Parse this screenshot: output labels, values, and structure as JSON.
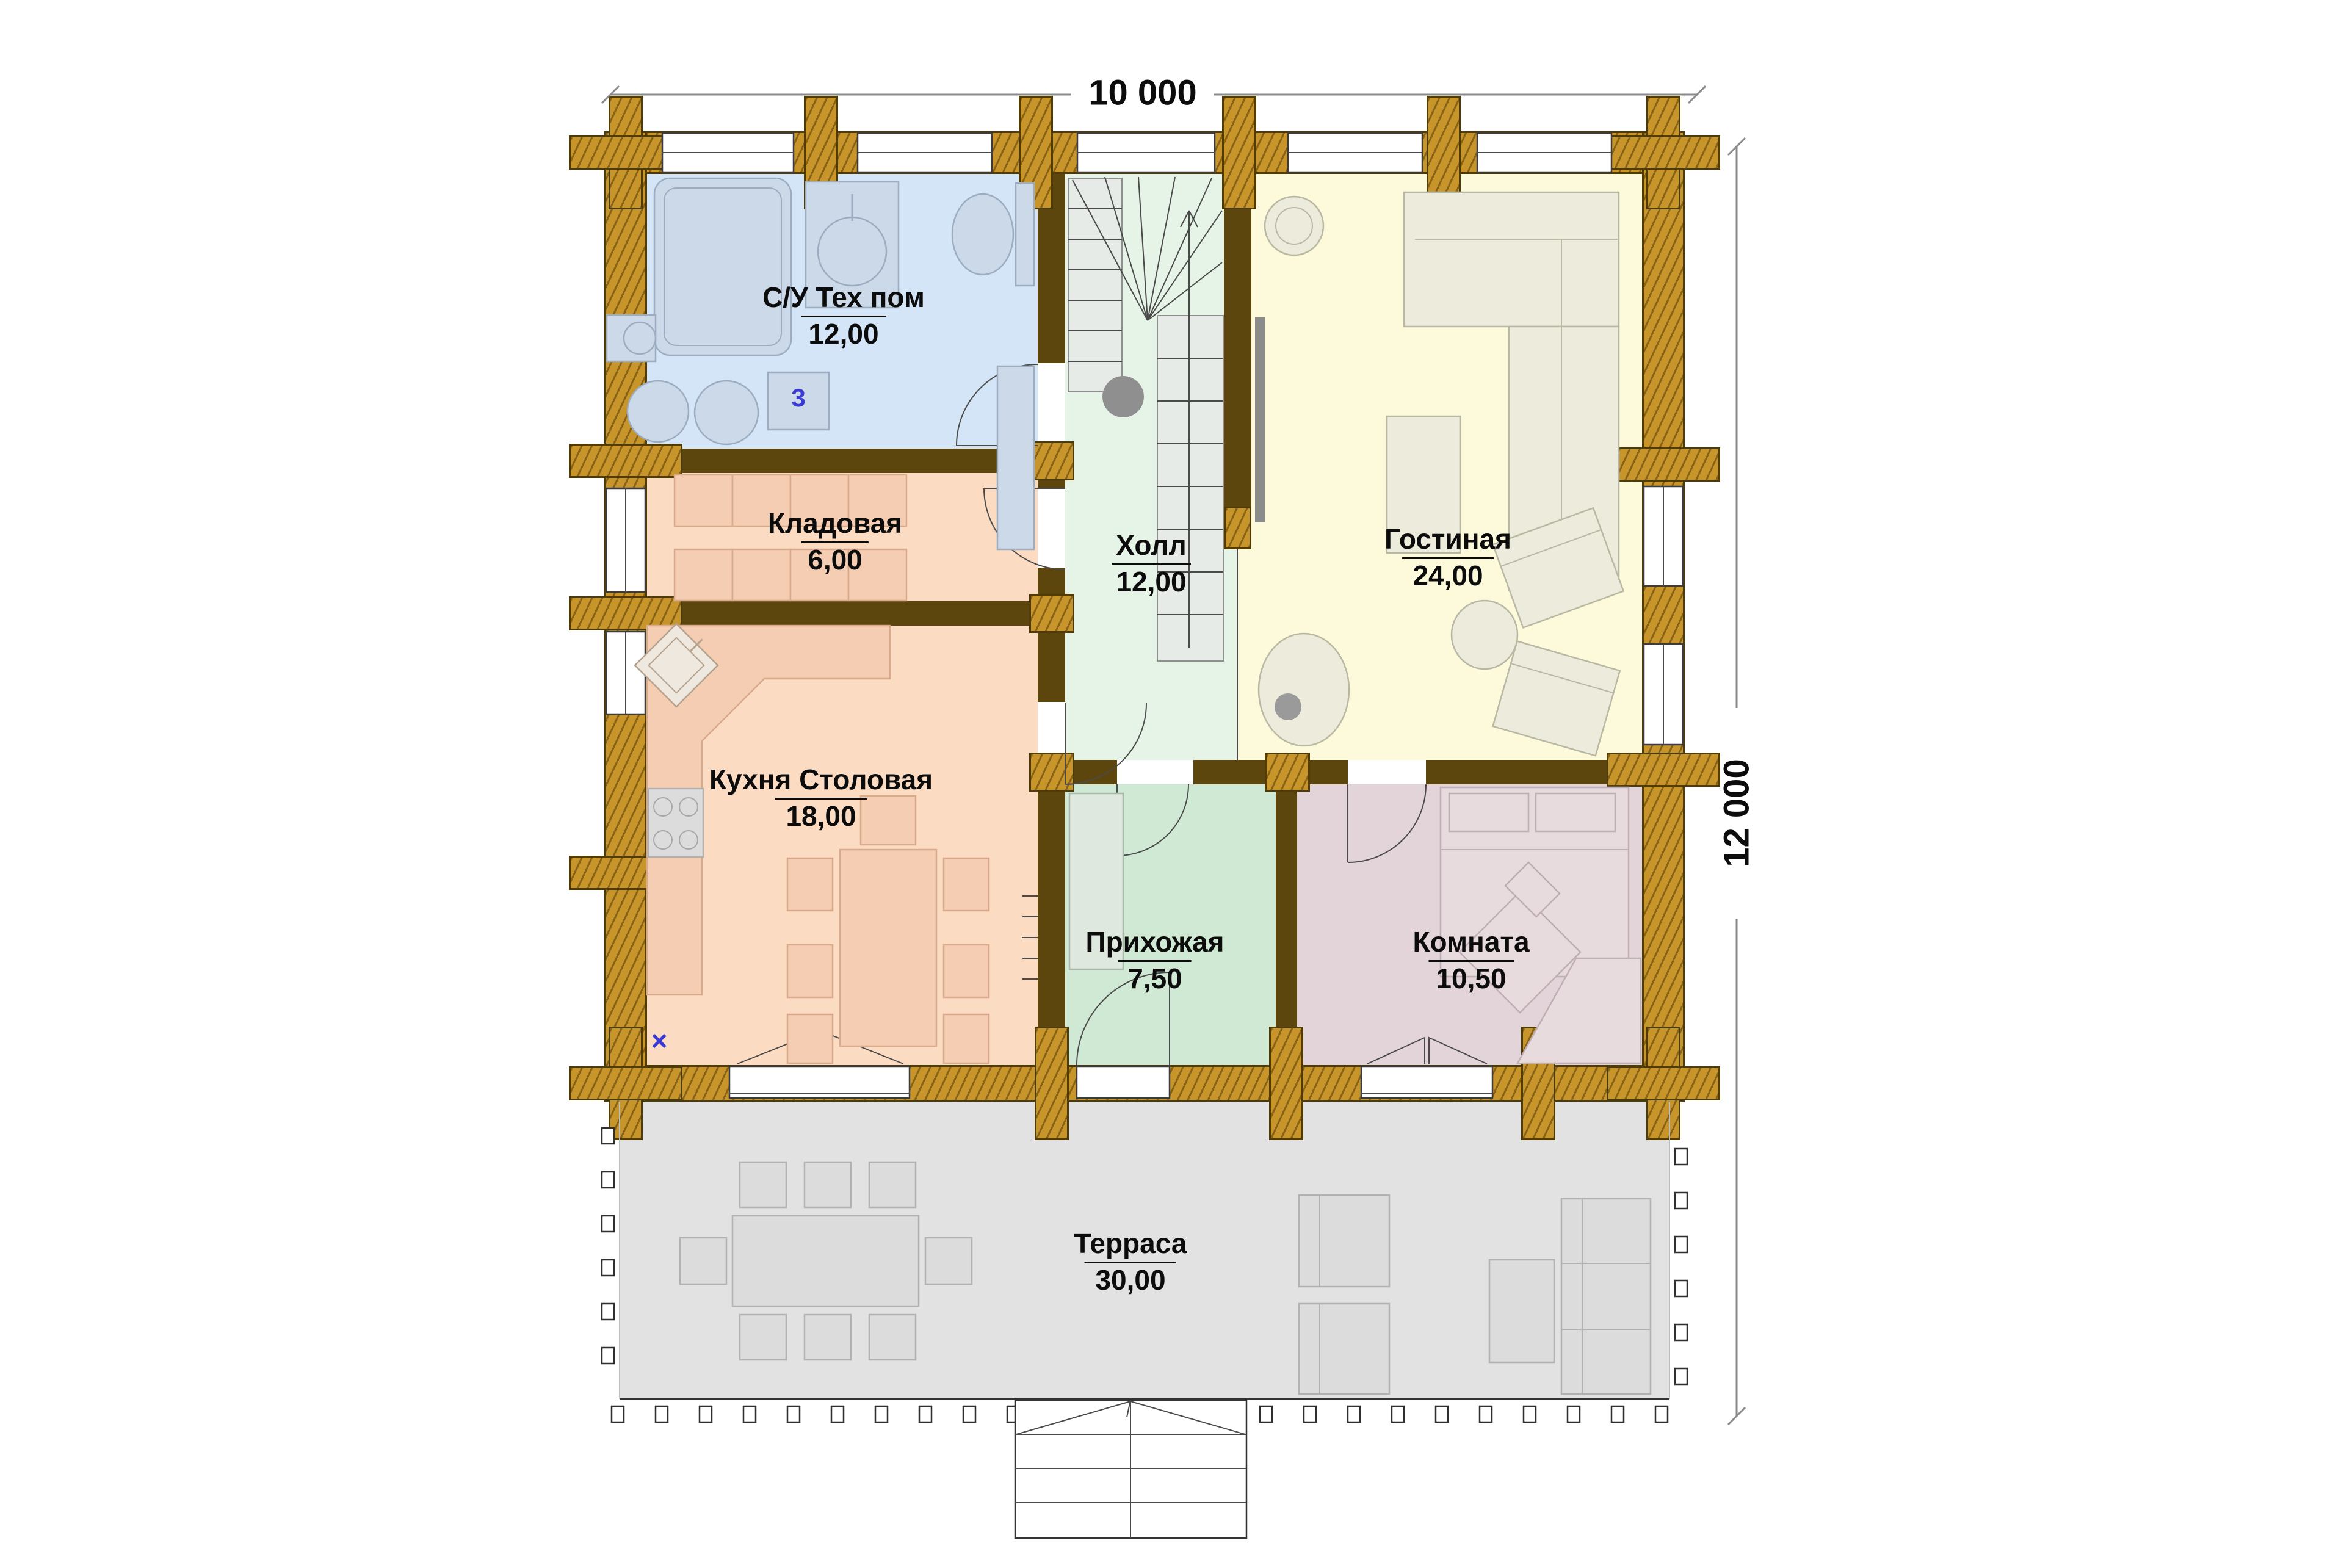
{
  "plan": {
    "title": "floor-plan",
    "dimensions": {
      "width_label": "10 000",
      "height_label": "12 000"
    },
    "rooms": [
      {
        "id": "su",
        "name": "С/У Тех пом",
        "area": "12,00",
        "color": "#d4e5f8"
      },
      {
        "id": "holl",
        "name": "Холл",
        "area": "12,00",
        "color": "#e6f3e7"
      },
      {
        "id": "gostinaya",
        "name": "Гостиная",
        "area": "24,00",
        "color": "#fcfadb"
      },
      {
        "id": "kladovaya",
        "name": "Кладовая",
        "area": "6,00",
        "color": "#fbdcc2"
      },
      {
        "id": "kuhnya",
        "name": "Кухня Столовая",
        "area": "18,00",
        "color": "#fbdcc2"
      },
      {
        "id": "prihozhaya",
        "name": "Прихожая",
        "area": "7,50",
        "color": "#cfe9d5"
      },
      {
        "id": "komnata",
        "name": "Комната",
        "area": "10,50",
        "color": "#e3d4d9"
      },
      {
        "id": "terrasa",
        "name": "Терраса",
        "area": "30,00",
        "color": "#e2e2e2"
      }
    ],
    "markers": {
      "unit3": "3",
      "xmark": "×"
    },
    "wall_colors": {
      "log": "#c8952a",
      "partition": "#5c460e"
    }
  }
}
